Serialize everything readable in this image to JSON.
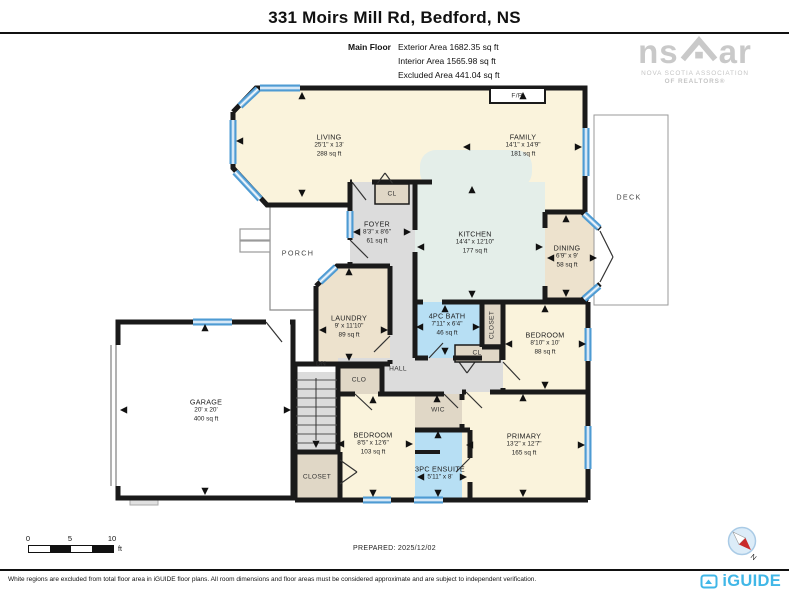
{
  "header": {
    "title": "331 Moirs Mill Rd, Bedford, NS",
    "floor_label": "Main Floor",
    "area_lines": [
      "Exterior Area 1682.35 sq ft",
      "Interior Area 1565.98 sq ft",
      "Excluded Area 441.04 sq ft"
    ]
  },
  "nsar_logo": {
    "ns": "ns",
    "ar": "ar",
    "line1": "NOVA SCOTIA ASSOCIATION",
    "line2": "OF REALTORS®"
  },
  "rooms": {
    "living": {
      "name": "LIVING",
      "dims": "25'1\" x 13'",
      "area": "288 sq ft"
    },
    "family": {
      "name": "FAMILY",
      "dims": "14'1\" x 14'9\"",
      "area": "181 sq ft"
    },
    "foyer": {
      "name": "FOYER",
      "dims": "8'3\" x 8'6\"",
      "area": "61 sq ft"
    },
    "kitchen": {
      "name": "KITCHEN",
      "dims": "14'4\" x 12'10\"",
      "area": "177 sq ft"
    },
    "dining": {
      "name": "DINING",
      "dims": "6'9\" x 9'",
      "area": "58 sq ft"
    },
    "laundry": {
      "name": "LAUNDRY",
      "dims": "9' x 11'10\"",
      "area": "89 sq ft"
    },
    "bath": {
      "name": "4PC BATH",
      "dims": "7'11\" x 6'4\"",
      "area": "46 sq ft"
    },
    "bedroom2": {
      "name": "BEDROOM",
      "dims": "8'10\" x 10'",
      "area": "88 sq ft"
    },
    "bedroom3": {
      "name": "BEDROOM",
      "dims": "8'5\" x 12'6\"",
      "area": "103 sq ft"
    },
    "primary": {
      "name": "PRIMARY",
      "dims": "13'2\" x 12'7\"",
      "area": "165 sq ft"
    },
    "ensuite": {
      "name": "3PC ENSUITE",
      "dims": "5'11\" x 8'"
    },
    "garage": {
      "name": "GARAGE",
      "dims": "20' x 20'",
      "area": "400 sq ft"
    }
  },
  "labels": {
    "deck": "DECK",
    "porch": "PORCH",
    "hall": "HALL",
    "wic": "WIC",
    "clo": "CLO",
    "closet_vertical": "CLOSET",
    "closet": "CLOSET",
    "cl_foyer": "CL",
    "cl_hall": "CL",
    "fp": "F/P",
    "dn": "DN",
    "compass_n": "N"
  },
  "scale_bar": {
    "ticks": [
      "0",
      "5",
      "10"
    ],
    "unit": "ft"
  },
  "footer": {
    "prepared": "PREPARED: 2025/12/02",
    "disclaimer": "White regions are excluded from total floor area in iGUIDE floor plans. All room dimensions and floor areas must be considered approximate and are subject to independent verification.",
    "brand": "iGUIDE"
  },
  "colors": {
    "room_cream": "#FAF3DC",
    "room_tan": "#EDE2CD",
    "closet_tan": "#E0D7C6",
    "hall_gray": "#DCDCDC",
    "kitchen_green": "#E4EEE9",
    "bath_blue": "#B7DFF4",
    "window_blue": "#4E9BD3",
    "wall_black": "#1A1A1A",
    "brand_blue": "#41B7E7",
    "logo_gray": "#C9C9C9"
  }
}
